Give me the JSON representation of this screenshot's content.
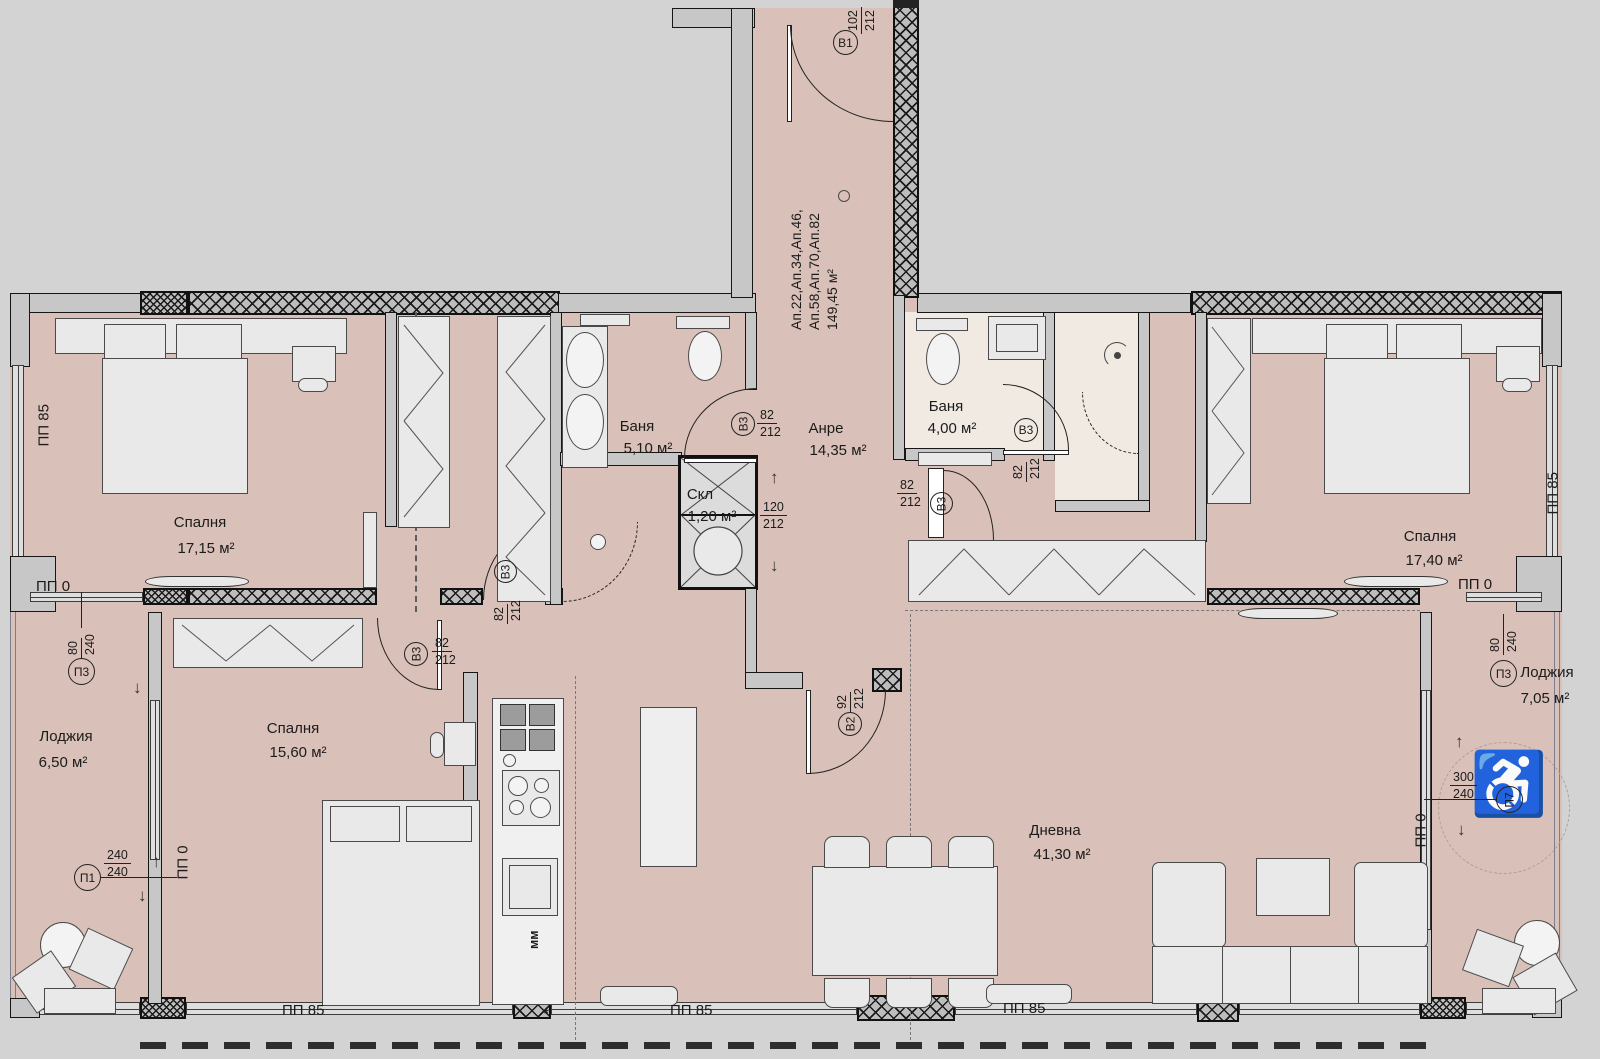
{
  "apartment_info": {
    "line1": "Ап.22,Ап.34,Ап.46,",
    "line2": "Ап.58,Ап.70,Ап.82",
    "line3": "149,45 м²"
  },
  "rooms": {
    "bedroom_left": {
      "name": "Спалня",
      "area": "17,15 м²"
    },
    "bedroom_middle": {
      "name": "Спалня",
      "area": "15,60 м²"
    },
    "bedroom_right": {
      "name": "Спалня",
      "area": "17,40 м²"
    },
    "bath_small": {
      "name": "Баня",
      "area": "5,10 м²"
    },
    "bath_main": {
      "name": "Баня",
      "area": "4,00 м²"
    },
    "hallway": {
      "name": "Анре",
      "area": "14,35 м²"
    },
    "closet": {
      "name": "Скл",
      "area": "1,20 м²"
    },
    "living": {
      "name": "Дневна",
      "area": "41,30 м²"
    },
    "loggia_left": {
      "name": "Лоджия",
      "area": "6,50 м²"
    },
    "loggia_right": {
      "name": "Лоджия",
      "area": "7,05 м²"
    }
  },
  "doors": {
    "b1": {
      "id": "B1",
      "w": "102",
      "h": "212"
    },
    "b2": {
      "id": "B2",
      "w": "92",
      "h": "212"
    },
    "b3_bath_small": {
      "id": "B3",
      "w": "82",
      "h": "212"
    },
    "b3_bath_main": {
      "id": "B3",
      "w": "82",
      "h": "212"
    },
    "b3_hall": {
      "id": "B3",
      "w": "82",
      "h": "212"
    },
    "b3_corridor": {
      "id": "B3",
      "w": "82",
      "h": "212"
    },
    "b3_bedroom_mid": {
      "id": "B3",
      "w": "82",
      "h": "212"
    }
  },
  "shaft_dim": {
    "w": "120",
    "h": "212"
  },
  "window_markers": {
    "p1": {
      "id": "П1",
      "a": "240",
      "b": "240"
    },
    "p3_left": {
      "id": "П3",
      "a": "80",
      "b": "240"
    },
    "p3_right": {
      "id": "П3",
      "a": "80",
      "b": "240"
    },
    "p7": {
      "id": "П7",
      "a": "300",
      "b": "240"
    }
  },
  "wall_labels": {
    "pp85": "ПП 85",
    "pp0": "ПП 0"
  },
  "kitchen": {
    "mm": "мм",
    "star": "*"
  },
  "symbols": {
    "wheelchair": "♿",
    "arrow_up": "↑",
    "arrow_down": "↓"
  },
  "colors": {
    "floor": "#d9c0b8",
    "bath_floor": "#f1eae3",
    "wall": "#c7c7c7",
    "outside": "#d3d3d3",
    "line": "#1b1b1b"
  }
}
